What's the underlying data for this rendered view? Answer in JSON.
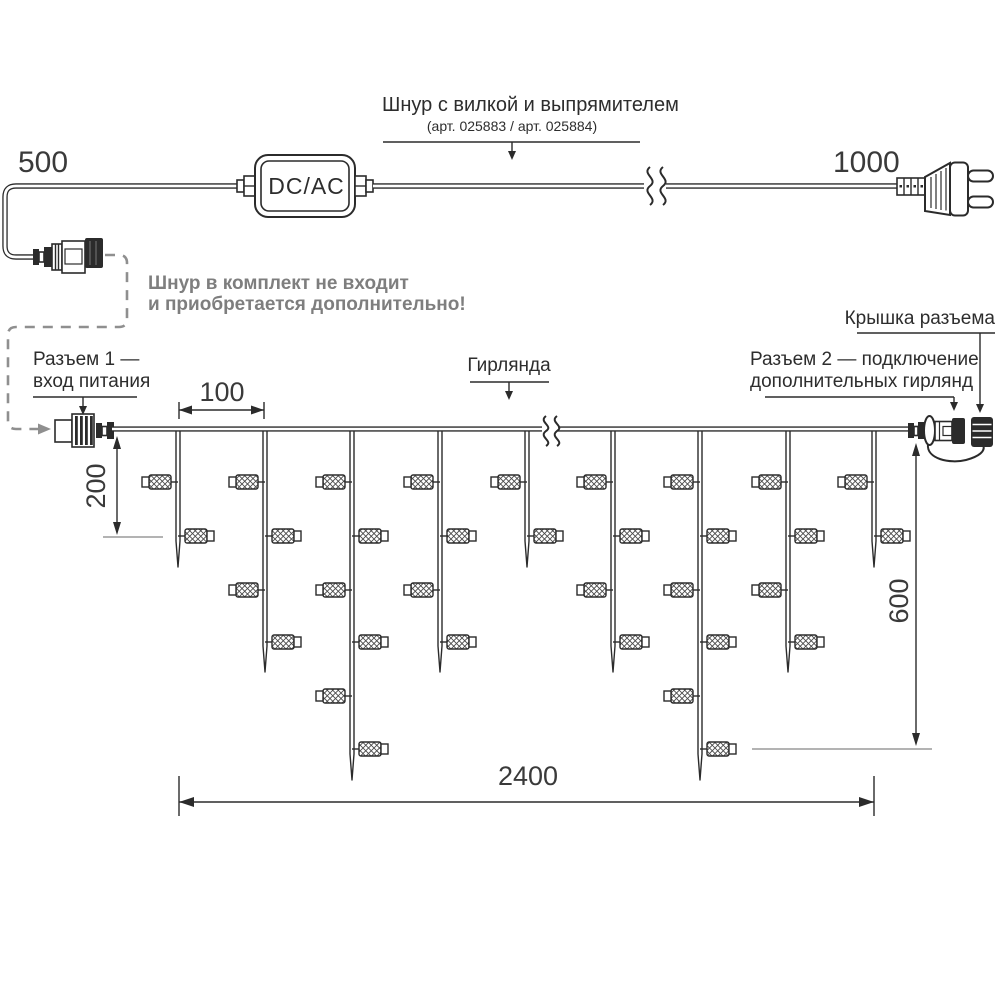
{
  "labels": {
    "cord_length_left": "500",
    "cord_length_right": "1000",
    "cord_title": "Шнур с вилкой и выпрямителем",
    "cord_subtitle": "(арт. 025883 / арт. 025884)",
    "converter": "DC/AC",
    "note_line1": "Шнур в комплект не входит",
    "note_line2": "и приобретается дополнительно!",
    "connector1_line1": "Разъем 1 —",
    "connector1_line2": "вход питания",
    "garland": "Гирлянда",
    "cap_label": "Крышка разъема",
    "connector2_line1": "Разъем 2 — подключение",
    "connector2_line2": "дополнительных гирлянд",
    "dim_spacing": "100",
    "dim_drop": "200",
    "dim_height": "600",
    "dim_length": "2400"
  },
  "colors": {
    "line": "#2b2b2b",
    "gray_text": "#7e7e7e",
    "gray_line": "#9a9a9a",
    "dashed_path": "#8f8f8f",
    "background": "#ffffff"
  },
  "garland": {
    "wire_y": 429,
    "wire_x1": 112,
    "wire_x2": 908,
    "break_x": 550,
    "lamp_rows": [
      482,
      536,
      590,
      642,
      696,
      749
    ],
    "types": {
      "short": {
        "lamps": 2,
        "tip": 567
      },
      "medium": {
        "lamps": 4,
        "tip": 672
      },
      "long": {
        "lamps": 6,
        "tip": 780
      }
    },
    "drops": [
      {
        "x": 178,
        "type": "short"
      },
      {
        "x": 265,
        "type": "medium"
      },
      {
        "x": 352,
        "type": "long"
      },
      {
        "x": 440,
        "type": "medium"
      },
      {
        "x": 527,
        "type": "short"
      },
      {
        "x": 613,
        "type": "medium"
      },
      {
        "x": 700,
        "type": "long"
      },
      {
        "x": 788,
        "type": "medium"
      },
      {
        "x": 874,
        "type": "short"
      }
    ]
  }
}
